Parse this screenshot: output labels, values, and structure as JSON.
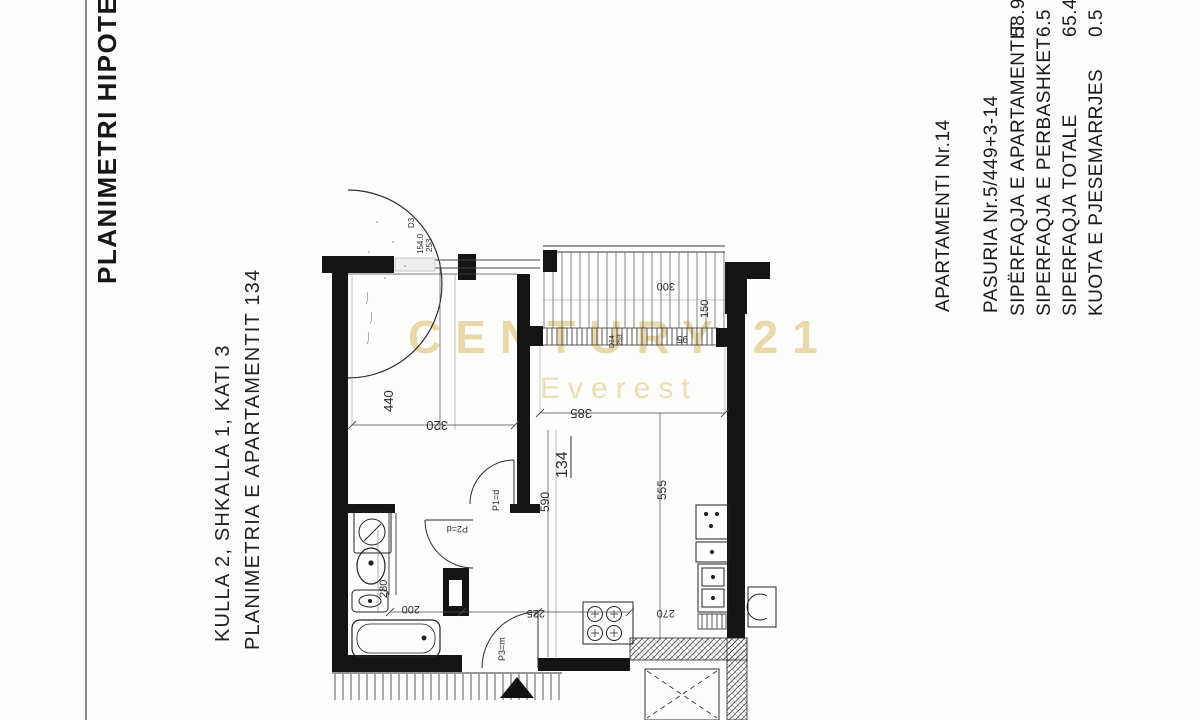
{
  "document": {
    "side_title": "PLANIMETRI HIPOTEKORE",
    "left_block": {
      "line1": "KULLA 2, SHKALLA 1, KATI 3",
      "line2": "PLANIMETRIA E APARTAMENTIT 134"
    },
    "right_block": {
      "apartment_no": "APARTAMENTI Nr.14",
      "property": "PASURIA Nr.5/449+3-14",
      "rows": [
        {
          "label": "SIPËRFAQJA E APARTAMENTIT",
          "value": "58.9"
        },
        {
          "label": "SIPERFAQJA E PERBASHKET",
          "value": "6.5"
        },
        {
          "label": "SIPERFAQJA TOTALE",
          "value": "65.4"
        },
        {
          "label": "KUOTA E PJESEMARRJES",
          "value": "0.5"
        }
      ]
    }
  },
  "watermark": {
    "brand": "CENTURY 21",
    "sub": "Everest",
    "color": "#e8d8aa"
  },
  "plan": {
    "room_number": "134",
    "dims": {
      "w440": "440",
      "w320": "320",
      "w385": "385",
      "w590": "590",
      "w555": "555",
      "w280": "280",
      "w200": "200",
      "w225": "225",
      "w270": "270",
      "w300": "300",
      "w150": "150",
      "w95": "95"
    },
    "entry": {
      "d3": "D3",
      "radius": "154.0",
      "depth": "253"
    },
    "balcony": {
      "d14": "D14",
      "c253": "253"
    },
    "doors": {
      "p1": "P1=d",
      "p2": "P2=d",
      "p3": "P3=m"
    }
  }
}
